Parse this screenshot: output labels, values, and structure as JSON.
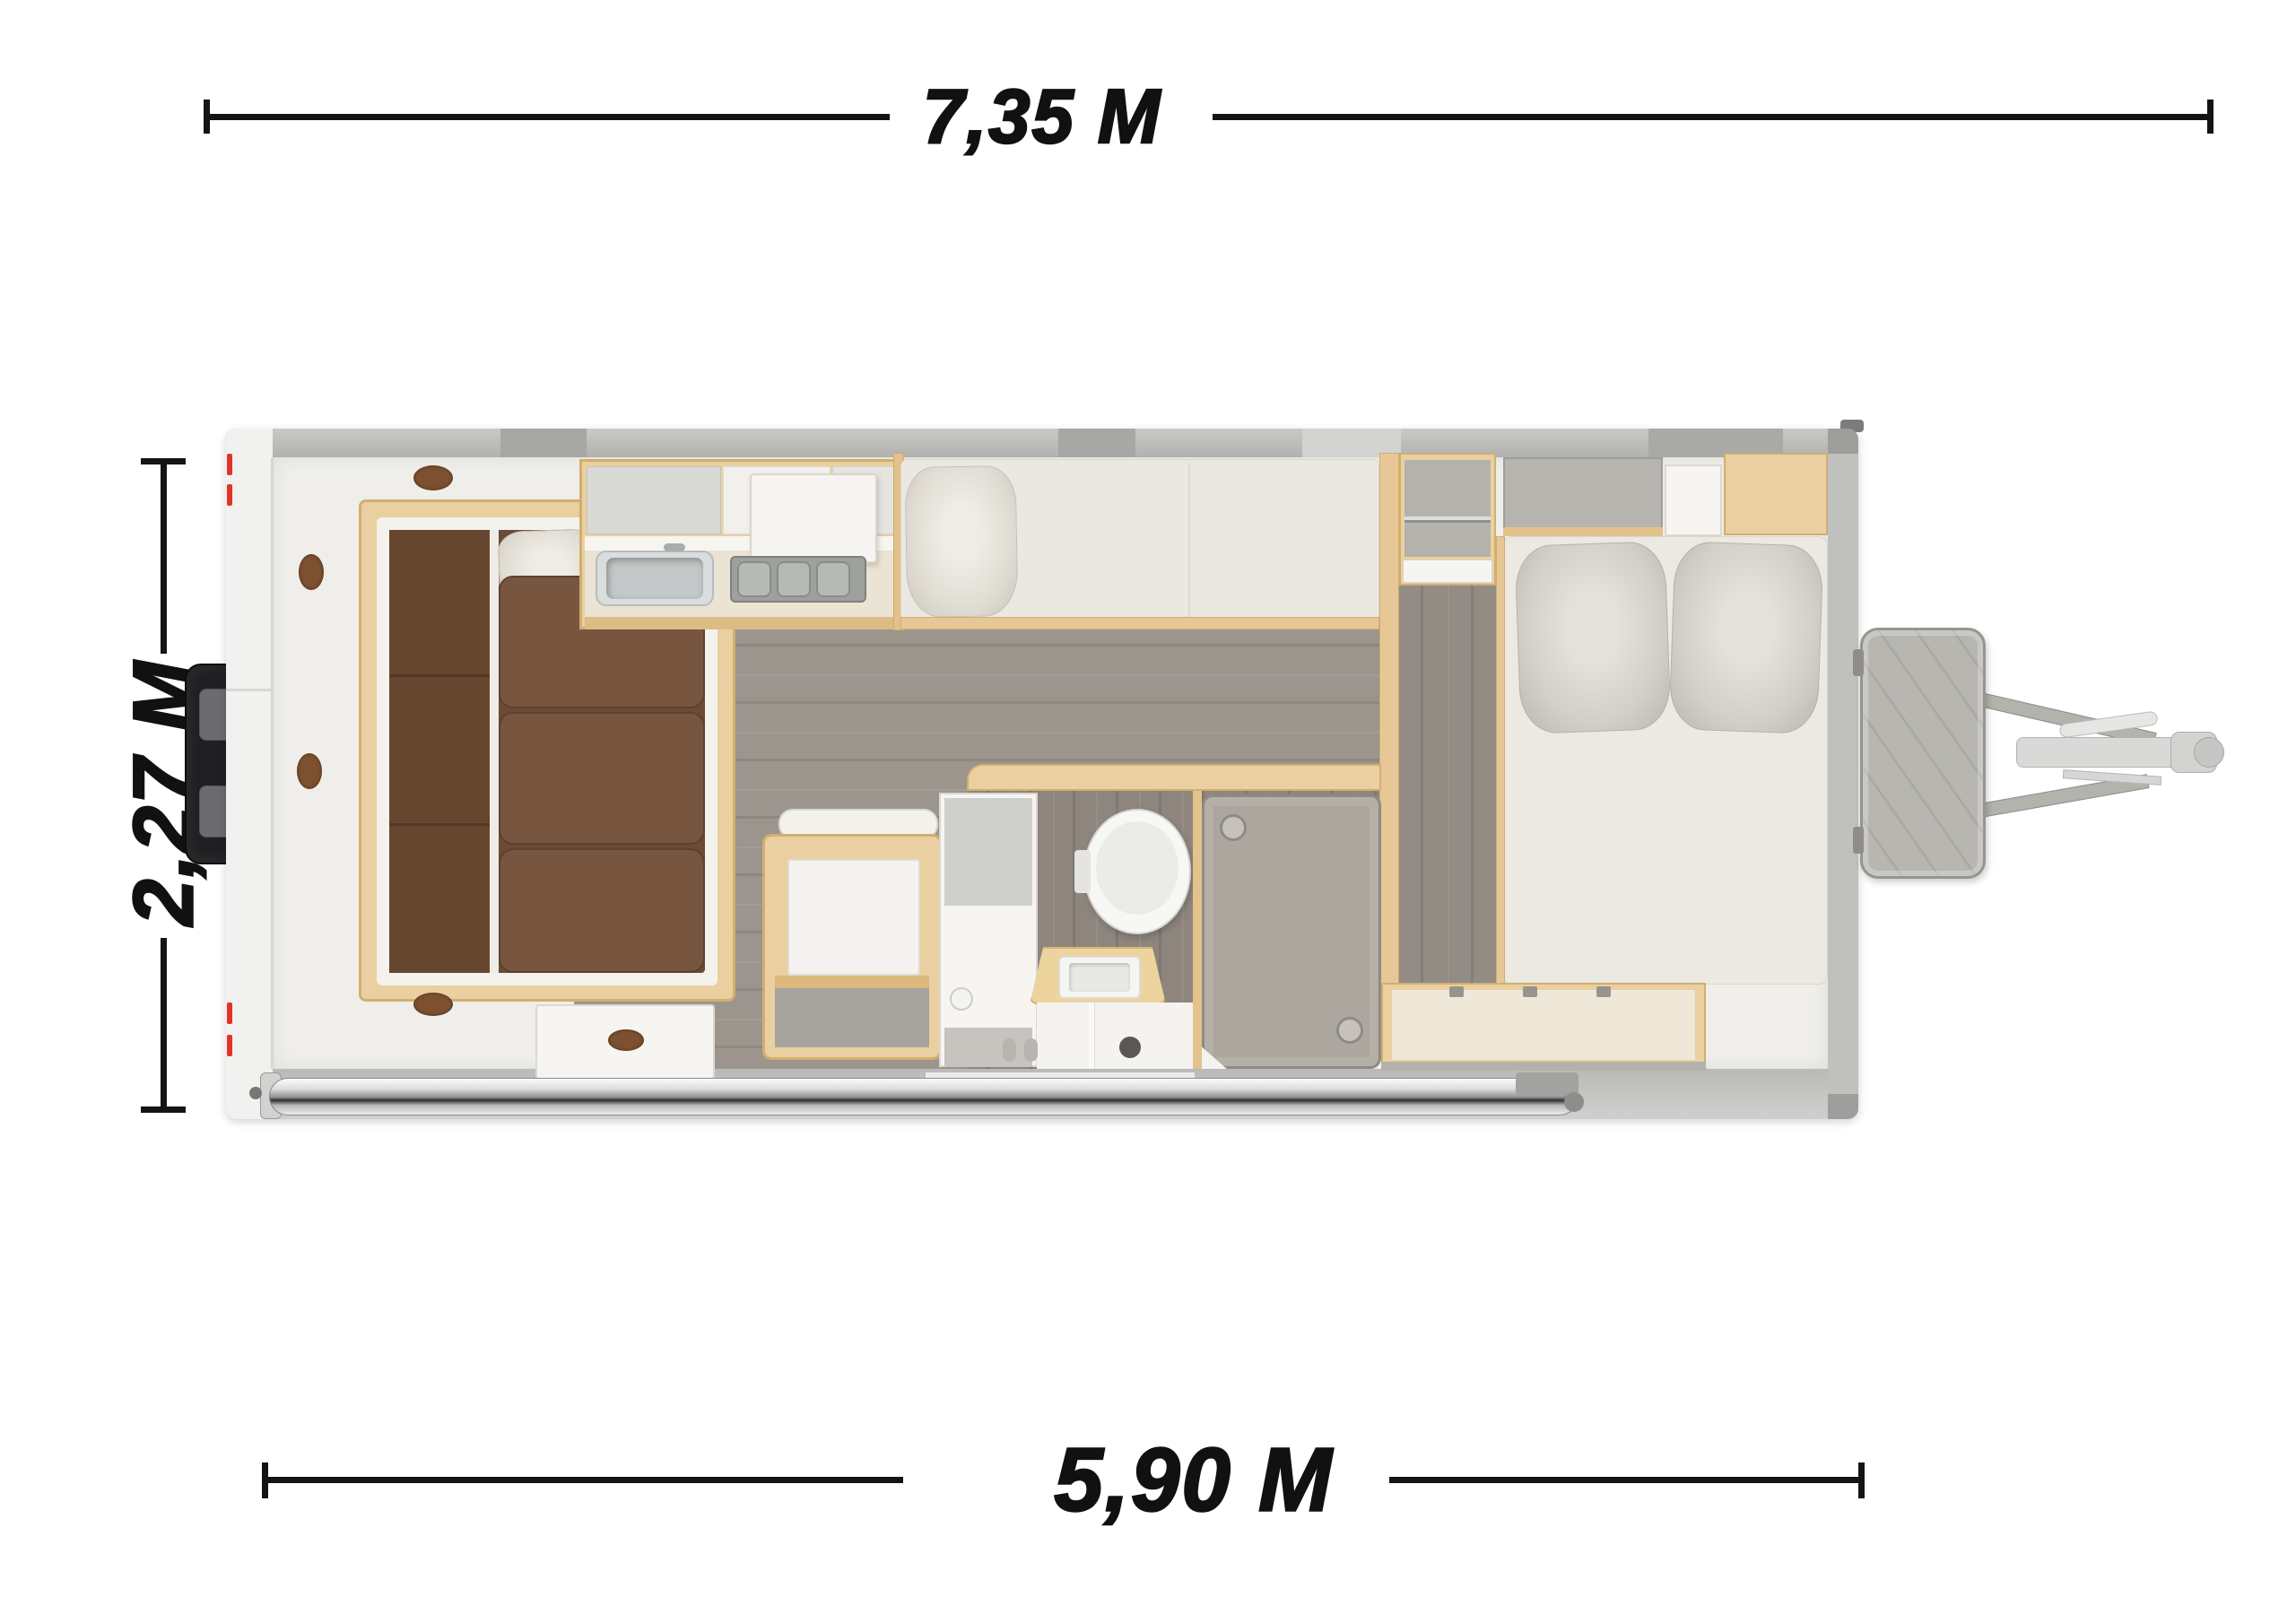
{
  "diagram": {
    "type": "caravan-floor-plan-top-view",
    "background": "#ffffff",
    "dimension_labels": {
      "total_length": "7,35 M",
      "body_width": "2,27 M",
      "body_length": "5,90 M"
    },
    "palette": {
      "label_ink": "#111111",
      "dimension_line": "#141414",
      "exterior_gray": "#bcbcba",
      "wall_white": "#efeeea",
      "wood_trim": "#ead0a0",
      "wood_edge": "#d2ae70",
      "sofa_brown": "#77553f",
      "sofa_brown_dark": "#5d4130",
      "mattress": "#ebe8e2",
      "floor_gray": "#9b958d",
      "bathroom_floor": "#8e867e",
      "shower_tray": "#aba79f",
      "chrome": "#dedede",
      "marker_red": "#e23426",
      "rear_box_black": "#202023",
      "gas_box_gray": "#b7b6b0"
    },
    "features": [
      "u-shaped-lounge",
      "kitchen-sink",
      "kitchen-cooktop",
      "single-bed",
      "double-bed",
      "toilet",
      "vanity-basin",
      "shower",
      "dinette-table",
      "wardrobe-shelves",
      "under-bed-storage",
      "awning-roller",
      "rear-storage-box",
      "gas-bottle-box",
      "a-frame-hitch"
    ]
  }
}
